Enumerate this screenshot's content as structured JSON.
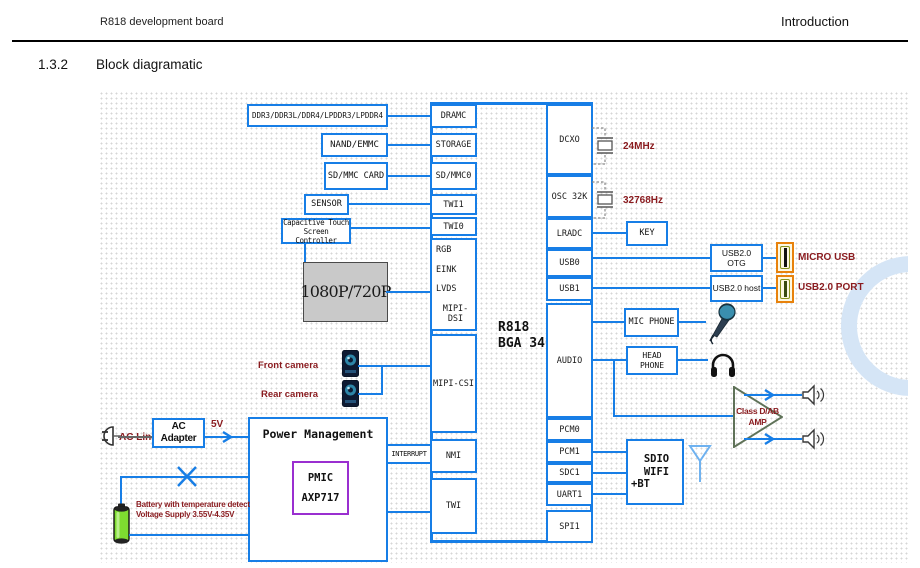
{
  "page": {
    "header_left": "R818 development board",
    "header_right": "Introduction",
    "section_number": "1.3.2",
    "section_title": "Block diagramatic"
  },
  "colors": {
    "line_blue": "#177ee6",
    "label_maroon": "#8a1b1f",
    "pmic_purple": "#9a2fd0",
    "connector_orange": "#e8820c",
    "display_gray": "#c9c9c9",
    "battery_green": "#7edc30"
  },
  "chip": {
    "title_line1": "R818",
    "title_line2": "BGA 346",
    "left_pins": {
      "dramc": "DRAMC",
      "storage": "STORAGE",
      "sdmmc0": "SD/MMC0",
      "twi1": "TWI1",
      "twi0": "TWI0",
      "display_group": [
        "RGB",
        "EINK",
        "LVDS",
        "MIPI-DSI"
      ],
      "mipicsi": "MIPI-CSI",
      "nmi": "NMI",
      "twi": "TWI"
    },
    "right_pins": {
      "dcxo": "DCXO",
      "osc32k": "OSC 32K",
      "lradc": "LRADC",
      "usb0": "USB0",
      "usb1": "USB1",
      "audio": "AUDIO",
      "pcm0": "PCM0",
      "pcm1": "PCM1",
      "sdc1": "SDC1",
      "uart1": "UART1",
      "spi1": "SPI1"
    }
  },
  "peripherals": {
    "ddr": "DDR3/DDR3L/DDR4/LPDDR3/LPDDR4",
    "nand": "NAND/EMMC",
    "sd_card": "SD/MMC CARD",
    "sensor": "SENSOR",
    "touch_line1": "Capacitive Touch",
    "touch_line2": "Screen Controller",
    "display": "1080P/720P",
    "front_camera": "Front camera",
    "rear_camera": "Rear camera",
    "xtal_24m": "24MHz",
    "xtal_32k": "32768Hz",
    "key": "KEY",
    "usb_otg": "USB2.0 OTG",
    "usb_host": "USB2.0 host",
    "micro_usb": "MICRO USB",
    "usb2_port": "USB2.0 PORT",
    "mic_phone": "MIC PHONE",
    "head_phone": "HEAD PHONE",
    "amp_line1": "Class D/AB",
    "amp_line2": "AMP",
    "sdio_line1": "SDIO WIFI",
    "sdio_line2": "+BT"
  },
  "power": {
    "ac_line": "AC Line",
    "ac_adapter": "AC Adapter",
    "v5": "5V",
    "pm_title": "Power Management",
    "pmic_line1": "PMIC",
    "pmic_line2": "AXP717",
    "interrupt": "INTERRUPT",
    "battery_line1": "Battery with temperature detect",
    "battery_line2": "Voltage Supply 3.55V-4.35V"
  },
  "icons": {
    "plug": "ac-plug-icon",
    "battery": "battery-icon",
    "front_camera": "camera-icon",
    "rear_camera": "camera-icon",
    "microphone": "microphone-icon",
    "headphone": "headphone-icon",
    "speaker": "speaker-icon",
    "antenna": "antenna-icon",
    "crystal": "crystal-icon",
    "usb_connector": "usb-connector-icon",
    "arrow": "arrow-icon",
    "x_mark": "x-mark-icon",
    "amp_triangle": "amplifier-triangle-icon",
    "watermark": "watermark-circle"
  }
}
